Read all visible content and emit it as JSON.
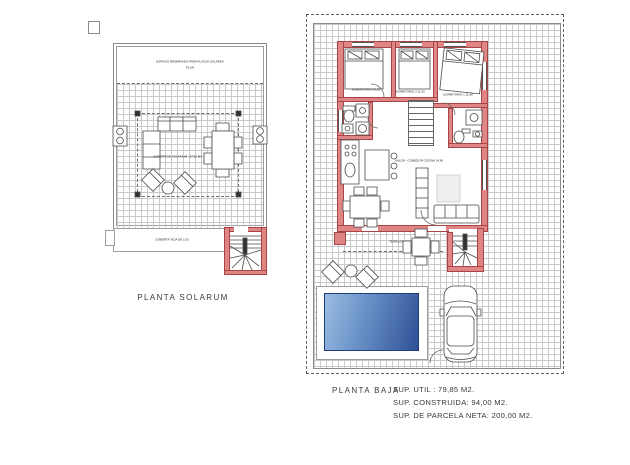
{
  "document": {
    "type": "architectural-floor-plan"
  },
  "colors": {
    "wall_fill": "#e08585",
    "wall_edge": "#a84444",
    "pool_light": "#9bbde2",
    "pool_dark": "#2e5096",
    "line": "#444444",
    "grid": "#c9c9c9"
  },
  "left_plan": {
    "name_label": "PLANTA SOLARUM",
    "top_note_line1": "ESPACIO RESERVADO PARA PLACAS SOLARES",
    "top_note_line2": "PLAN",
    "area_label": "SUPERFICIE SOLARIUM : 37,50 M2.",
    "roof_label": "CUBIERTA TEJA DE LOS"
  },
  "right_plan": {
    "name_label": "PLANTA BAJA",
    "room_labels": {
      "bedroom3": "DORMITORIO 3  8,05",
      "bedroom2": "DORMITORIO 2  11,05",
      "bedroom1": "DORMITORIO 1  11,60",
      "living": "SALON - COMEDOR COCINA  24,90",
      "terrace": "TERRAZA"
    },
    "stats": [
      "SUP. UTIL : 79,85 M2.",
      "SUP. CONSTRUIDA: 94,00 M2.",
      "SUP. DE PARCELA NETA: 200,00 M2."
    ]
  }
}
